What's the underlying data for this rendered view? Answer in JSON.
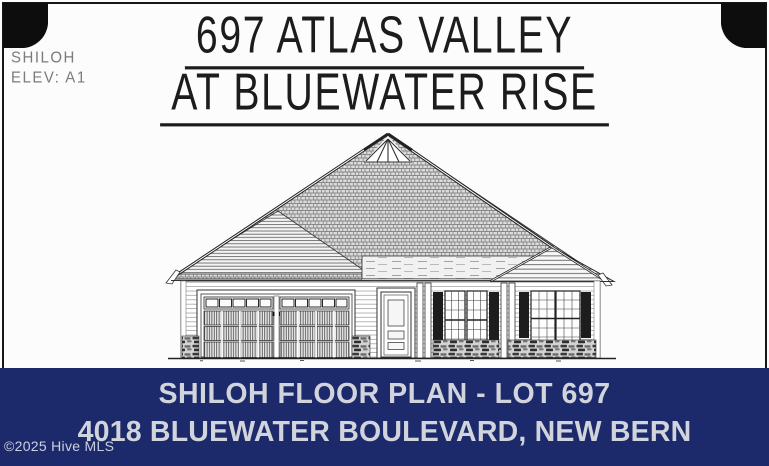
{
  "plan_label": {
    "line1": "SHILOH",
    "line2": "ELEV: A1"
  },
  "title": {
    "line1": "697 ATLAS VALLEY",
    "line2": "AT BLUEWATER RISE"
  },
  "drawing": {
    "type": "house-front-elevation",
    "features": "center shingled gable with sunburst peak, left garage wing with double garage door, front door with porch, shuttered windows, stone skirt",
    "line_color": "#2b2b2b",
    "shutter_color": "#1d1d1d"
  },
  "banner": {
    "line1": "SHILOH FLOOR PLAN - LOT 697",
    "line2": "4018 BLUEWATER BOULEVARD, NEW BERN",
    "bg_color": "#1c2a6b",
    "text_color": "#d2d4dc"
  },
  "watermark": "©2025 Hive MLS",
  "decor": {
    "corner_color": "#0d0d0d"
  }
}
